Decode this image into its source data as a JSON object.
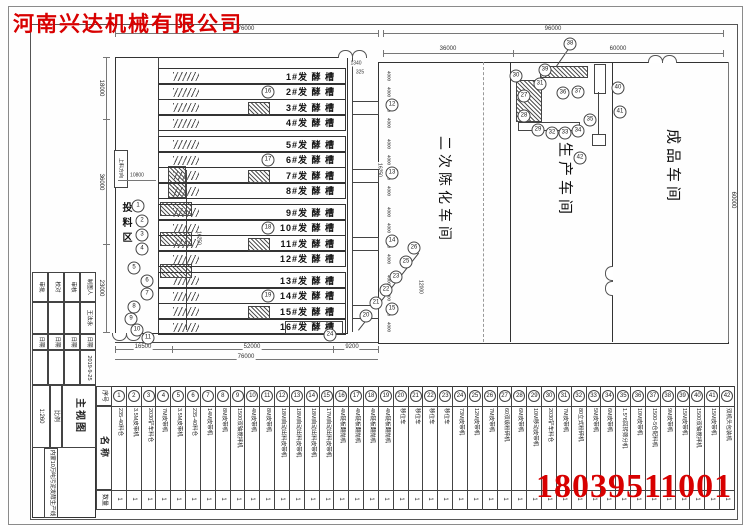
{
  "company": {
    "name": "河南兴达机械有限公司",
    "color": "#d80000"
  },
  "phone": {
    "number": "18039511001",
    "color": "#d80000"
  },
  "drawing": {
    "tanks": [
      "1#发 酵 槽",
      "2#发 酵 槽",
      "3#发 酵 槽",
      "4#发 酵 槽",
      "5#发 酵 槽",
      "6#发 酵 槽",
      "7#发 酵 槽",
      "8#发 酵 槽",
      "9#发 酵 槽",
      "10#发 酵 槽",
      "11#发 酵 槽",
      "12#发 酵 槽",
      "13#发 酵 槽",
      "14#发 酵 槽",
      "15#发 酵 槽",
      "16#发 酵 槽"
    ],
    "workshops": [
      {
        "name": "二次陈化车间"
      },
      {
        "name": "生产车间"
      },
      {
        "name": "成品车间"
      }
    ],
    "feed_area_label": "投料区",
    "feed_direction_label": "上料方向",
    "dimensions": {
      "top": [
        "76000",
        "96000",
        "36000",
        "60000"
      ],
      "bottom": [
        "16500",
        "52000",
        "9200",
        "76000"
      ],
      "left": [
        "18000",
        "36000",
        "23000"
      ],
      "right": [
        "60000"
      ],
      "inner": [
        "10800",
        "16250",
        "16250",
        "4000",
        "1340",
        "325",
        "12000"
      ]
    },
    "markers": [
      {
        "n": 1,
        "x": 138,
        "y": 206
      },
      {
        "n": 2,
        "x": 142,
        "y": 221
      },
      {
        "n": 3,
        "x": 142,
        "y": 235
      },
      {
        "n": 4,
        "x": 142,
        "y": 249
      },
      {
        "n": 5,
        "x": 134,
        "y": 268
      },
      {
        "n": 6,
        "x": 147,
        "y": 281
      },
      {
        "n": 7,
        "x": 147,
        "y": 294
      },
      {
        "n": 8,
        "x": 134,
        "y": 307
      },
      {
        "n": 9,
        "x": 131,
        "y": 319
      },
      {
        "n": 10,
        "x": 137,
        "y": 330
      },
      {
        "n": 11,
        "x": 148,
        "y": 338
      },
      {
        "n": 12,
        "x": 392,
        "y": 105
      },
      {
        "n": 13,
        "x": 392,
        "y": 173
      },
      {
        "n": 14,
        "x": 392,
        "y": 241
      },
      {
        "n": 15,
        "x": 392,
        "y": 309
      },
      {
        "n": 16,
        "x": 268,
        "y": 92
      },
      {
        "n": 17,
        "x": 268,
        "y": 160
      },
      {
        "n": 18,
        "x": 268,
        "y": 228
      },
      {
        "n": 19,
        "x": 268,
        "y": 296
      },
      {
        "n": 20,
        "x": 366,
        "y": 316
      },
      {
        "n": 21,
        "x": 376,
        "y": 303
      },
      {
        "n": 22,
        "x": 386,
        "y": 290
      },
      {
        "n": 23,
        "x": 396,
        "y": 277
      },
      {
        "n": 24,
        "x": 330,
        "y": 335
      },
      {
        "n": 25,
        "x": 406,
        "y": 262
      },
      {
        "n": 26,
        "x": 414,
        "y": 248
      },
      {
        "n": 27,
        "x": 524,
        "y": 96
      },
      {
        "n": 28,
        "x": 524,
        "y": 116
      },
      {
        "n": 29,
        "x": 538,
        "y": 130
      },
      {
        "n": 30,
        "x": 516,
        "y": 76
      },
      {
        "n": 31,
        "x": 540,
        "y": 84
      },
      {
        "n": 32,
        "x": 552,
        "y": 133
      },
      {
        "n": 33,
        "x": 565,
        "y": 133
      },
      {
        "n": 34,
        "x": 578,
        "y": 131
      },
      {
        "n": 35,
        "x": 590,
        "y": 120
      },
      {
        "n": 36,
        "x": 563,
        "y": 93
      },
      {
        "n": 37,
        "x": 578,
        "y": 92
      },
      {
        "n": 38,
        "x": 570,
        "y": 44
      },
      {
        "n": 39,
        "x": 545,
        "y": 70
      },
      {
        "n": 40,
        "x": 618,
        "y": 88
      },
      {
        "n": 41,
        "x": 620,
        "y": 112
      },
      {
        "n": 42,
        "x": 580,
        "y": 158
      }
    ]
  },
  "equipment_table": {
    "headers": {
      "no": "序号",
      "name": "名称",
      "qty": "数量"
    },
    "rows": [
      {
        "no": "1",
        "name": "235-40料仓",
        "qty": "1"
      },
      {
        "no": "2",
        "name": "3.5M皮带机",
        "qty": "1"
      },
      {
        "no": "3",
        "name": "2030铲车料仓",
        "qty": "1"
      },
      {
        "no": "4",
        "name": "7M皮带机",
        "qty": "1"
      },
      {
        "no": "5",
        "name": "3.5M皮带机",
        "qty": "1"
      },
      {
        "no": "6",
        "name": "235-40料仓",
        "qty": "1"
      },
      {
        "no": "7",
        "name": "14M皮带机",
        "qty": "1"
      },
      {
        "no": "8",
        "name": "8M皮带机",
        "qty": "1"
      },
      {
        "no": "9",
        "name": "1500双轴搅拌机",
        "qty": "1"
      },
      {
        "no": "10",
        "name": "4M皮带机",
        "qty": "1"
      },
      {
        "no": "11",
        "name": "8M皮带机",
        "qty": "1"
      },
      {
        "no": "12",
        "name": "18M自动出料皮带机",
        "qty": "1"
      },
      {
        "no": "13",
        "name": "18M自动出料皮带机",
        "qty": "1"
      },
      {
        "no": "14",
        "name": "18M自动出料皮带机",
        "qty": "1"
      },
      {
        "no": "15",
        "name": "17M自动出料皮带机",
        "qty": "1"
      },
      {
        "no": "16",
        "name": "4M链板翻抛机",
        "qty": "1"
      },
      {
        "no": "17",
        "name": "4M链板翻抛机",
        "qty": "1"
      },
      {
        "no": "18",
        "name": "4M链板翻抛机",
        "qty": "1"
      },
      {
        "no": "19",
        "name": "4M链板翻抛机",
        "qty": "1"
      },
      {
        "no": "20",
        "name": "移位车",
        "qty": "1"
      },
      {
        "no": "21",
        "name": "移位车",
        "qty": "1"
      },
      {
        "no": "22",
        "name": "移位车",
        "qty": "1"
      },
      {
        "no": "23",
        "name": "移位车",
        "qty": "1"
      },
      {
        "no": "24",
        "name": "73M皮带机",
        "qty": "1"
      },
      {
        "no": "25",
        "name": "12M皮带机",
        "qty": "1"
      },
      {
        "no": "26",
        "name": "7M皮带机",
        "qty": "1"
      },
      {
        "no": "27",
        "name": "60双级粉碎机",
        "qty": "1"
      },
      {
        "no": "28",
        "name": "6M皮带机",
        "qty": "1"
      },
      {
        "no": "29",
        "name": "10M移动皮带机",
        "qty": "1"
      },
      {
        "no": "30",
        "name": "2030铲车料仓",
        "qty": "1"
      },
      {
        "no": "31",
        "name": "7M皮带机",
        "qty": "1"
      },
      {
        "no": "32",
        "name": "80立式粉碎机",
        "qty": "1"
      },
      {
        "no": "33",
        "name": "5M皮带机",
        "qty": "1"
      },
      {
        "no": "34",
        "name": "6M皮带机",
        "qty": "1"
      },
      {
        "no": "35",
        "name": "1.5*6回转筛分机",
        "qty": "1"
      },
      {
        "no": "36",
        "name": "10M皮带机",
        "qty": "1"
      },
      {
        "no": "37",
        "name": "1500-5仓配料机",
        "qty": "1"
      },
      {
        "no": "38",
        "name": "9M皮带机",
        "qty": "1"
      },
      {
        "no": "39",
        "name": "15M皮带机",
        "qty": "1"
      },
      {
        "no": "40",
        "name": "1500双轴搅拌机",
        "qty": "1"
      },
      {
        "no": "41",
        "name": "15M皮带机",
        "qty": "1"
      },
      {
        "no": "42",
        "name": "双机头包装机",
        "qty": "1"
      }
    ]
  },
  "title_block": {
    "approval_cols": [
      {
        "label": "审批",
        "value": "",
        "date_label": "日期",
        "date": ""
      },
      {
        "label": "校对",
        "value": "",
        "date_label": "日期",
        "date": ""
      },
      {
        "label": "审核",
        "value": "",
        "date_label": "日期",
        "date": ""
      },
      {
        "label": "制图人",
        "value": "王法永",
        "date_label": "日期",
        "date": "2019-9-25"
      }
    ],
    "scale_value": "1:260",
    "scale_label": "比例",
    "view_name": "主视图",
    "project": "内蒙10万吨污泥发酵生产线"
  }
}
